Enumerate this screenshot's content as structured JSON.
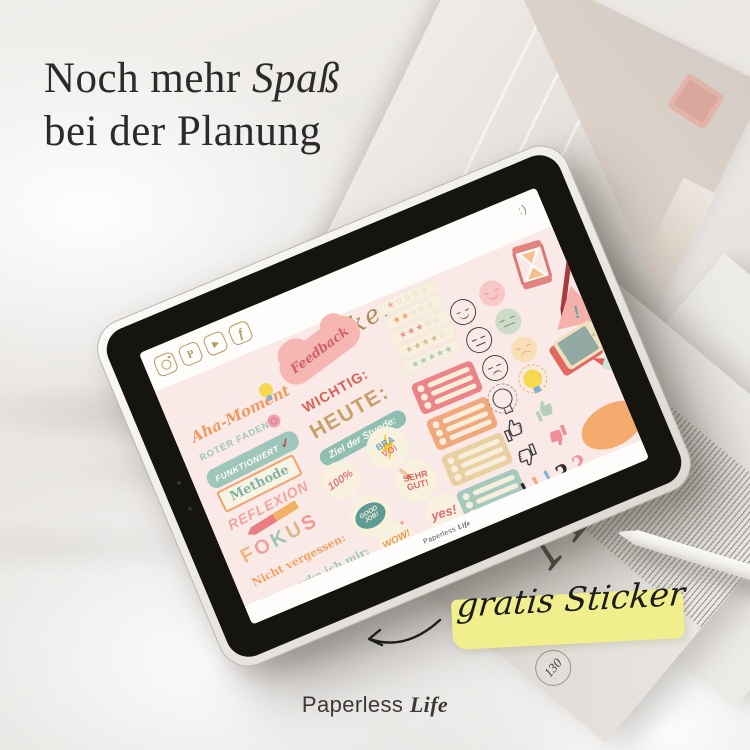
{
  "headline": {
    "line1_start": "Noch mehr",
    "line1_em": "Spaß",
    "line2": "bei der Planung"
  },
  "promo": {
    "label": "gratis Sticker",
    "highlight_color": "#f1ee8d"
  },
  "brand": {
    "first": "Paperless",
    "second": "Life"
  },
  "magazine": {
    "page_number": "130",
    "caption": "enkl |"
  },
  "tablet_screen": {
    "emoticon": ":)",
    "page_title": "Sticker",
    "watermark_first": "Paperless",
    "watermark_second": "Life",
    "social": [
      "instagram",
      "pinterest",
      "youtube",
      "facebook"
    ],
    "words": {
      "aha": "Aha-Moment",
      "roter_faden": "Roter Faden",
      "funktioniert": "funktioniert",
      "check": "✓",
      "methode": "Methode",
      "reflexion": "Reflexion",
      "nicht_vergessen": "Nicht vergessen:",
      "merke": "Das merke ich mir:",
      "feedback": "Feedback",
      "wichtig": "Wichtig:",
      "heute": "Heute:",
      "ziel": "Ziel der Stunde:"
    },
    "fokus_letters": [
      {
        "ch": "F",
        "color": "#f3b577"
      },
      {
        "ch": "O",
        "color": "#f1a3a0"
      },
      {
        "ch": "K",
        "color": "#9ec6b9"
      },
      {
        "ch": "U",
        "color": "#d9b98c"
      },
      {
        "ch": "S",
        "color": "#ef9a8f"
      }
    ],
    "badges": {
      "b100": "100%",
      "bravo_1": "Bra",
      "bravo_2": "vo!",
      "good_1": "Good",
      "good_2": "Job!",
      "sehr_1": "Sehr",
      "sehr_2": "gut!",
      "wow": "Wow!",
      "yes": "yes!"
    },
    "ratings": [
      {
        "filled": 1,
        "color": "#ecaaa5"
      },
      {
        "filled": 2,
        "color": "#f0a36b"
      },
      {
        "filled": 3,
        "color": "#ed8f8c"
      },
      {
        "filled": 4,
        "color": "#d9bb90"
      },
      {
        "filled": 5,
        "color": "#a9c8bb"
      }
    ],
    "checklist_colors": [
      "#ec8387",
      "#f1a87d",
      "#e9d0a2",
      "#a5c9bd"
    ],
    "punctuation": [
      {
        "ch": "!",
        "color": "#2e2b29"
      },
      {
        "ch": "!",
        "color": "#f2a86e"
      },
      {
        "ch": "!",
        "color": "#85b2d3"
      },
      {
        "ch": "?",
        "color": "#2e2b29"
      },
      {
        "ch": "?",
        "color": "#ef93a2"
      }
    ],
    "warning_mark": "!"
  }
}
